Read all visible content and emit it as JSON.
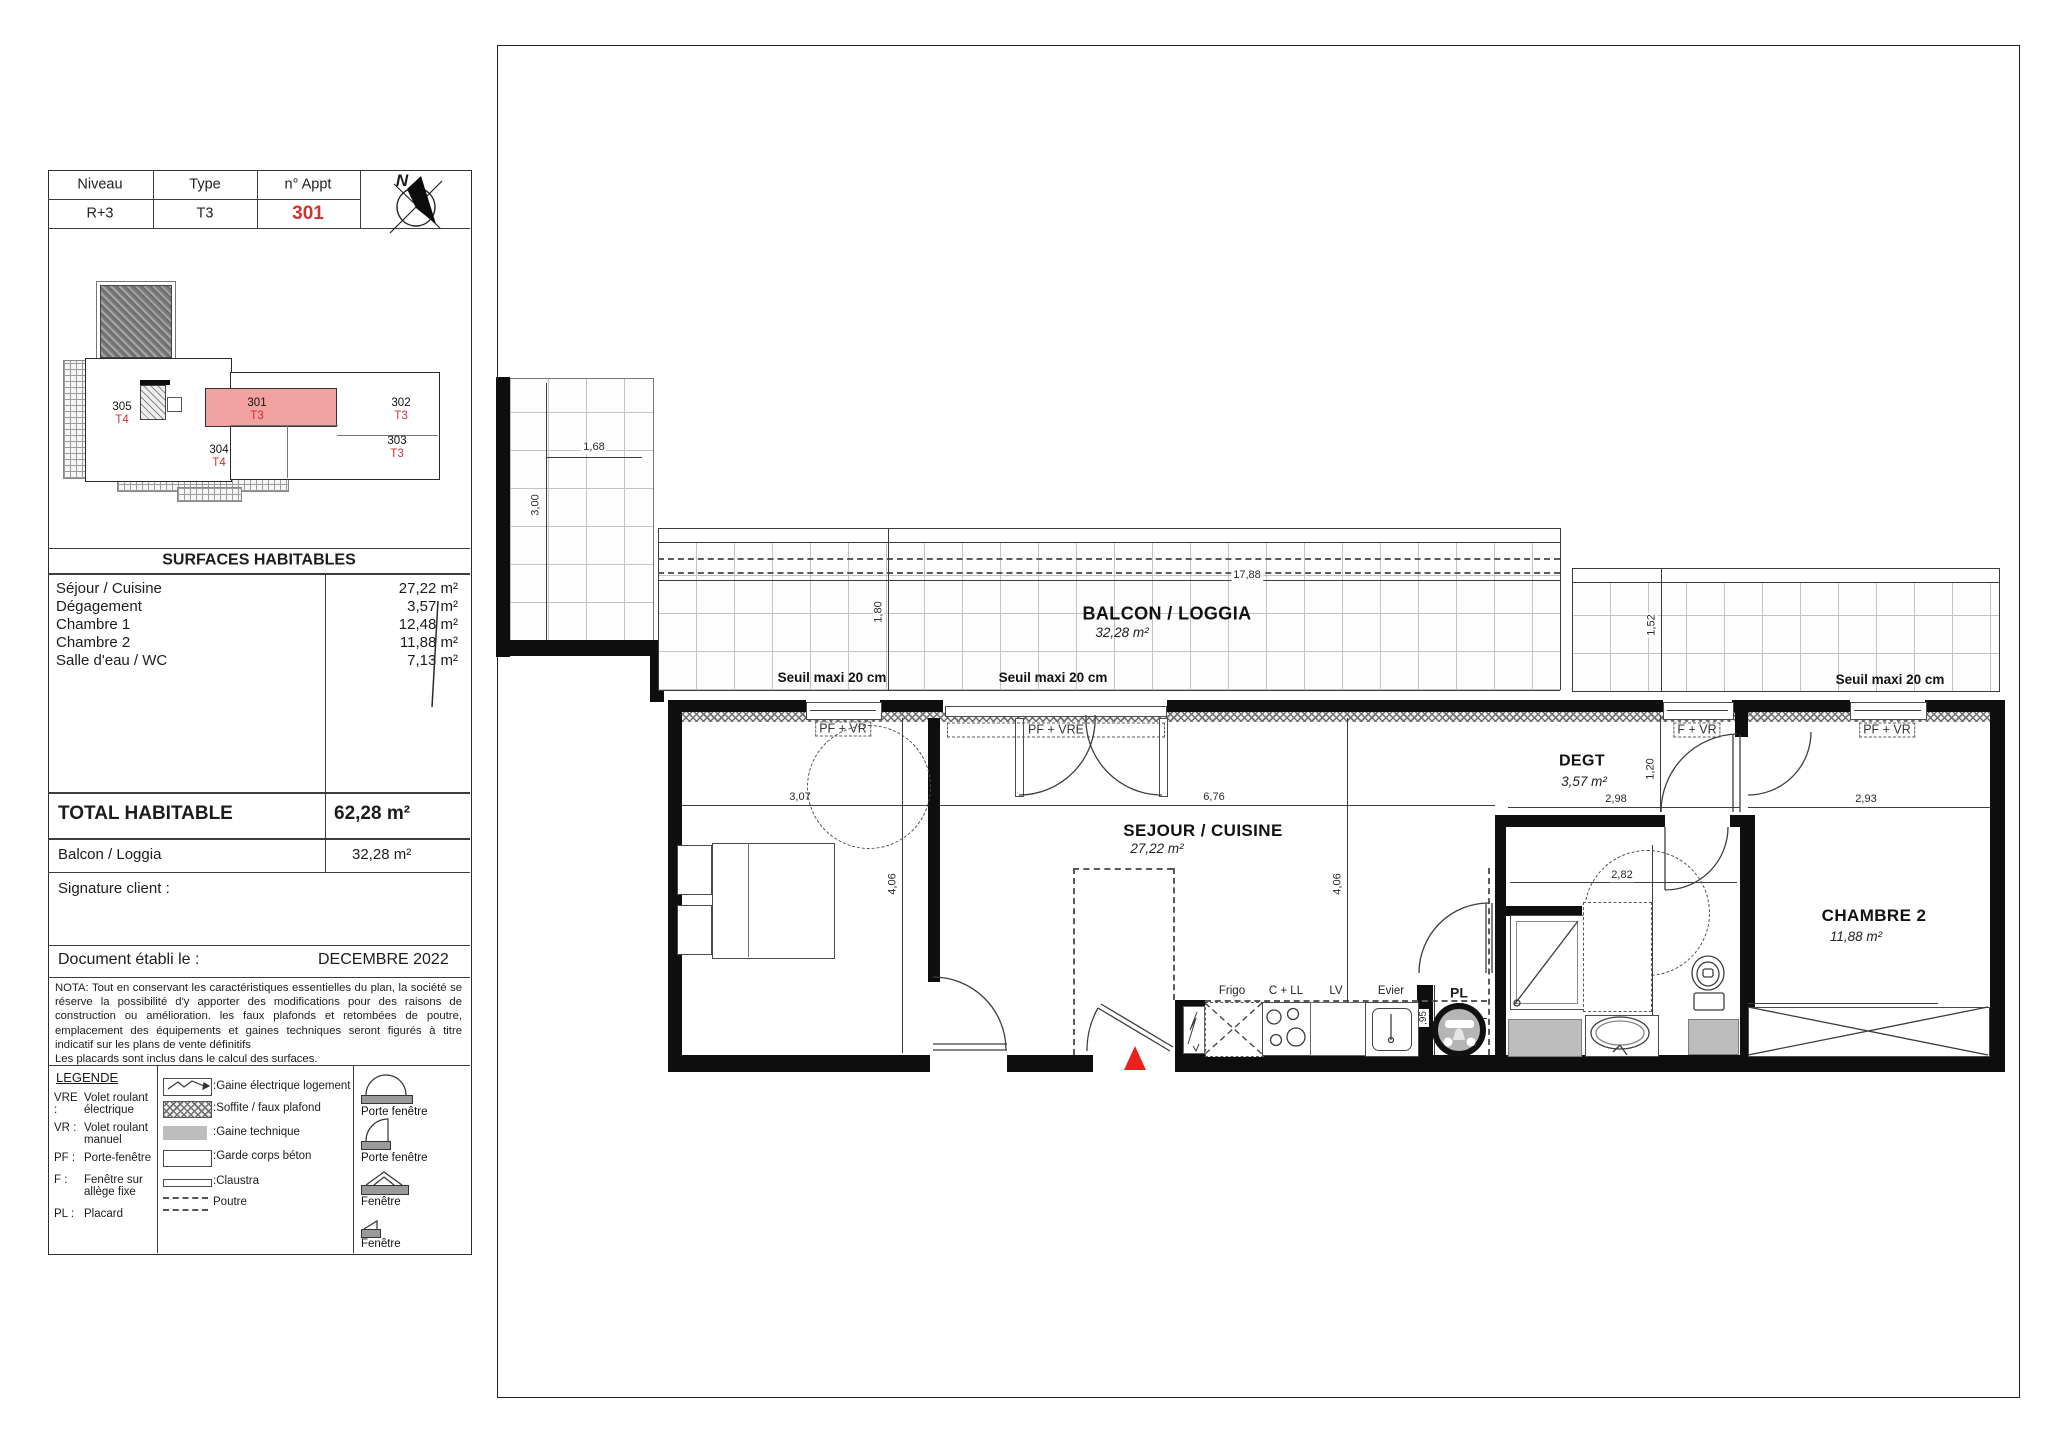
{
  "header": {
    "niveau_label": "Niveau",
    "type_label": "Type",
    "appt_label": "n° Appt",
    "niveau_value": "R+3",
    "type_value": "T3",
    "appt_value": "301",
    "compass": "N"
  },
  "key_plan": {
    "units": [
      {
        "num": "305",
        "type": "T4"
      },
      {
        "num": "304",
        "type": "T4"
      },
      {
        "num": "301",
        "type": "T3"
      },
      {
        "num": "302",
        "type": "T3"
      },
      {
        "num": "303",
        "type": "T3"
      }
    ]
  },
  "surfaces": {
    "title": "SURFACES HABITABLES",
    "rows": [
      {
        "label": "Séjour / Cuisine",
        "value": "27,22 m²"
      },
      {
        "label": "Dégagement",
        "value": "3,57 m²"
      },
      {
        "label": "Chambre 1",
        "value": "12,48 m²"
      },
      {
        "label": "Chambre 2",
        "value": "11,88 m²"
      },
      {
        "label": "Salle d'eau / WC",
        "value": "7,13 m²"
      }
    ],
    "total_label": "TOTAL HABITABLE",
    "total_value": "62,28 m²",
    "balcony_label": "Balcon / Loggia",
    "balcony_value": "32,28 m²"
  },
  "signature_label": "Signature client :",
  "document_row": {
    "label": "Document établi le :",
    "value": "DECEMBRE 2022"
  },
  "nota": {
    "line1": "NOTA: Tout en conservant les caractéristiques essentielles du plan, la société se réserve la possibilité d'y apporter des modifications pour des raisons de construction ou amélioration. les faux plafonds et retombées de poutre, emplacement des équipements et gaines techniques seront figurés à titre indicatif sur les plans de vente définitifs",
    "line2": "Les placards sont inclus dans le calcul des surfaces."
  },
  "legend": {
    "title": "LEGENDE",
    "abbr": [
      {
        "code": "VRE :",
        "label": "Volet roulant électrique"
      },
      {
        "code": "VR :",
        "label": "Volet roulant manuel"
      },
      {
        "code": "PF :",
        "label": "Porte-fenêtre"
      },
      {
        "code": "F :",
        "label": "Fenêtre sur allège fixe"
      },
      {
        "code": "PL :",
        "label": "Placard"
      }
    ],
    "symbols": [
      {
        "label": ":Gaine électrique logement"
      },
      {
        "label": ":Soffite / faux plafond"
      },
      {
        "label": ":Gaine technique"
      },
      {
        "label": ":Garde corps béton"
      },
      {
        "label": ":Claustra"
      },
      {
        "label": "Poutre"
      }
    ],
    "openings": [
      {
        "label": "Porte fenêtre"
      },
      {
        "label": "Porte fenêtre"
      },
      {
        "label": "Fenêtre"
      },
      {
        "label": "Fenêtre"
      }
    ]
  },
  "plan": {
    "rooms": {
      "balcon": {
        "name": "BALCON / LOGGIA",
        "area": "32,28 m²"
      },
      "chambre1": {
        "name": "CHAMBRE 1",
        "area": "12,48 m²"
      },
      "sejour": {
        "name": "SEJOUR / CUISINE",
        "area": "27,22 m²"
      },
      "degt": {
        "name": "DEGT",
        "area": "3,57 m²"
      },
      "sde": {
        "name": "SDE",
        "area": "7,13 m²"
      },
      "chambre2": {
        "name": "CHAMBRE 2",
        "area": "11,88 m²"
      }
    },
    "window_labels": [
      "PF + VR",
      "PF + VRE",
      "F + VR",
      "PF + VR"
    ],
    "seuil_label": "Seuil maxi 20 cm",
    "kitchen_labels": {
      "frigo": "Frigo",
      "cll": "C + LL",
      "lv": "LV",
      "evier": "Evier",
      "pl": "PL"
    },
    "dims": {
      "terrace_w": "1,68",
      "terrace_h": "3,00",
      "balcony_w": "17,88",
      "balcony_d": "1,80",
      "balcony2_d": "1,52",
      "c1_w": "3,07",
      "c1_h": "4,06",
      "sejour_w": "6,76",
      "sejour_h": "4,06",
      "degt_w": "2,98",
      "degt_h": "1,20",
      "c2_w": "2,93",
      "sde_w": "2,82",
      "sde_h": "2,81",
      "pl_d": ",95",
      "pl_w": ",90"
    }
  },
  "colors": {
    "highlight_pink": "#f2a1a1",
    "accent_red": "#cc3333",
    "triangle_red": "#e8231d",
    "gaine_gray": "#bdbdbd"
  }
}
